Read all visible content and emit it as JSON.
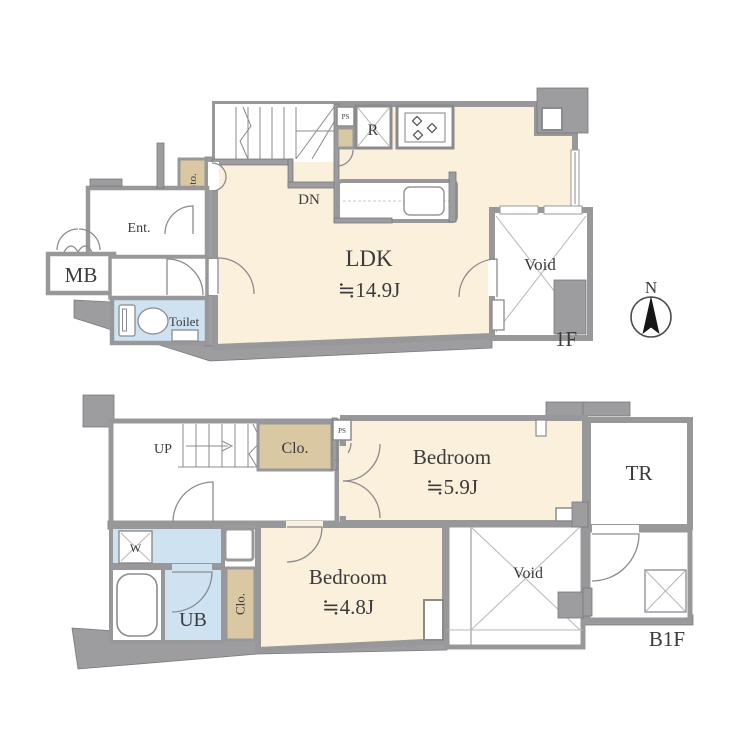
{
  "floor_1f": {
    "floor_label": "1F",
    "ldk": {
      "name": "LDK",
      "area": "≒14.9J"
    },
    "entrance_label": "Ent.",
    "mailbox_label": "MB",
    "shoebox_label": "SB",
    "storage_label": "Sto.",
    "toilet_label": "Toilet",
    "void_label": "Void",
    "stairs_label": "DN",
    "refrigerator_label": "R",
    "pipe_space_label": "PS"
  },
  "floor_b1f": {
    "floor_label": "B1F",
    "stairs_label": "UP",
    "closet_upper_label": "Clo.",
    "pipe_space_label": "PS",
    "bedroom_a": {
      "name": "Bedroom",
      "area": "≒5.9J"
    },
    "bedroom_b": {
      "name": "Bedroom",
      "area": "≒4.8J"
    },
    "trunk_room_label": "TR",
    "void_label": "Void",
    "washer_label": "W",
    "unit_bath_label": "UB",
    "closet_lower_label": "Clo."
  },
  "compass": {
    "north_label": "N"
  },
  "colors": {
    "room_floor": "#FAF0DB",
    "closet": "#D9C8A2",
    "wet_area": "#CEE2F2",
    "wall": "#9d9da0"
  }
}
